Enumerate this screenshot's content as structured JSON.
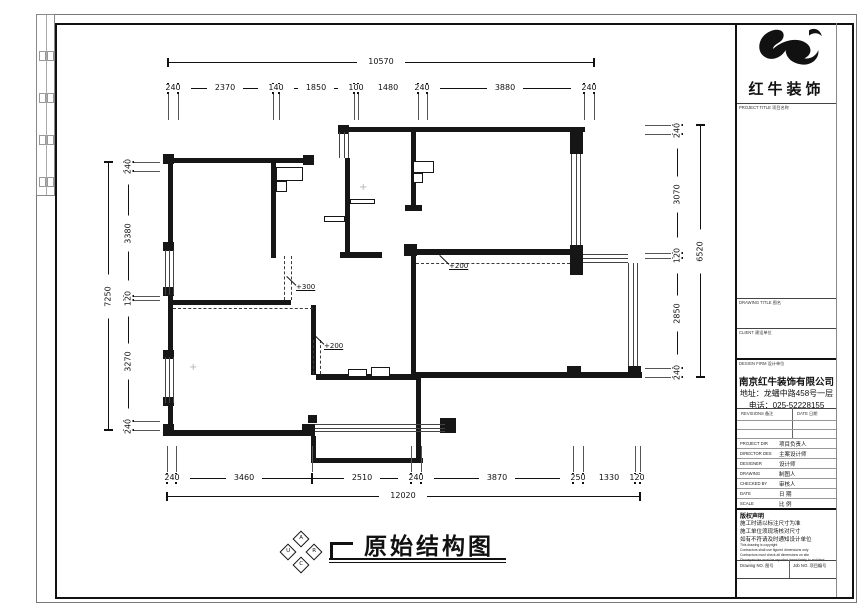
{
  "title_block": {
    "brand": {
      "name": "红牛装饰"
    },
    "labels": {
      "project_title": "PROJECT TITLE 项目名称",
      "drawing_title": "DRAWING TITLE 图名",
      "client": "CLIENT 建设单位",
      "design_firm": "DESIGN FIRM 设计单位"
    },
    "company": {
      "name": "南京红牛装饰有限公司",
      "address": "地址：龙蟠中路458号一层",
      "phone": "电话：025-52228155"
    },
    "revisions_header": {
      "revisions": "REVISIONS 备注",
      "date": "DATE 日期"
    },
    "staff_rows": [
      {
        "en": "PROJECT DIR",
        "zh": "项目负责人"
      },
      {
        "en": "DIRECTOR DES",
        "zh": "主案设计师"
      },
      {
        "en": "DESIGNER",
        "zh": "设计师"
      },
      {
        "en": "DRAWING",
        "zh": "制图人"
      },
      {
        "en": "CHECKED BY",
        "zh": "审核人"
      },
      {
        "en": "DATE",
        "zh": "日  期"
      },
      {
        "en": "SCALE",
        "zh": "比  例"
      }
    ],
    "notes": {
      "title": "版权声明",
      "lines_zh": [
        "施工时请以标注尺寸为准",
        "施工单位须现场核对尺寸",
        "如有不符请及时通知设计单位"
      ],
      "lines_en": [
        "This drawing is copyright",
        "Contractors shall use figured dimensions only",
        "Contractors must check all dimensions on site",
        "Discrepancies must be reported immediately to architect"
      ]
    },
    "footer": {
      "drawing_no": "Drawing NO. 图号",
      "job_no": "Job NO. 项目编号"
    }
  },
  "drawing": {
    "title": "原始结构图",
    "logo_letters": [
      "A",
      "U",
      "R",
      "C"
    ],
    "dimensions": {
      "top": {
        "overall": "10570",
        "segments": [
          "240",
          "2370",
          "140",
          "1850",
          "100",
          "1480",
          "240",
          "3880",
          "240"
        ]
      },
      "bottom": {
        "overall": "12020",
        "segments": [
          "240",
          "3460",
          "2510",
          "240",
          "3870",
          "250",
          "1330",
          "120"
        ]
      },
      "left": {
        "overall": "7250",
        "segments": [
          "240",
          "3380",
          "120",
          "3270",
          "240"
        ]
      },
      "right": {
        "overall": "6520",
        "segments": [
          "240",
          "3070",
          "120",
          "2850",
          "240"
        ]
      }
    },
    "dims_px": {
      "top": {
        "y": 88,
        "oy": 62,
        "ox": 381,
        "overall": "10570",
        "side": "down",
        "ticks": [
          168,
          178,
          273,
          279,
          354,
          358,
          418,
          427,
          584,
          594
        ],
        "labels": [
          [
            "240",
            173
          ],
          [
            "2370",
            225
          ],
          [
            "140",
            276
          ],
          [
            "1850",
            316
          ],
          [
            "100",
            356
          ],
          [
            "1480",
            388
          ],
          [
            "240",
            422
          ],
          [
            "3880",
            505
          ],
          [
            "240",
            589
          ]
        ]
      },
      "bottom": {
        "y": 478,
        "oy": 496,
        "ox": 403,
        "overall": "12020",
        "side": "up",
        "ticks": [
          167,
          176,
          312,
          411,
          421,
          573,
          583,
          635,
          640
        ],
        "labels": [
          [
            "240",
            172
          ],
          [
            "3460",
            244
          ],
          [
            "2510",
            362
          ],
          [
            "240",
            416
          ],
          [
            "3870",
            497
          ],
          [
            "250",
            578
          ],
          [
            "1330",
            609
          ],
          [
            "120",
            637
          ]
        ]
      },
      "left": {
        "x": 128,
        "ox": 108,
        "oyc": 296,
        "overall": "7250",
        "side": "right",
        "ticks": [
          162,
          171,
          296,
          300,
          421,
          430
        ],
        "labels": [
          [
            "240",
            166
          ],
          [
            "3380",
            233
          ],
          [
            "120",
            298
          ],
          [
            "3270",
            361
          ],
          [
            "240",
            426
          ]
        ]
      },
      "right": {
        "x": 677,
        "ox": 700,
        "oyc": 251,
        "overall": "6520",
        "side": "left",
        "ticks": [
          125,
          134,
          253,
          258,
          368,
          377
        ],
        "labels": [
          [
            "240",
            130
          ],
          [
            "3070",
            194
          ],
          [
            "120",
            255
          ],
          [
            "2850",
            313
          ],
          [
            "240",
            372
          ]
        ]
      }
    },
    "geometry": {
      "walls": [
        [
          168,
          158,
          145,
          5
        ],
        [
          342,
          127,
          243,
          5
        ],
        [
          168,
          163,
          5,
          85
        ],
        [
          168,
          295,
          5,
          62
        ],
        [
          168,
          405,
          5,
          31
        ],
        [
          168,
          430,
          147,
          6
        ],
        [
          271,
          163,
          5,
          95
        ],
        [
          345,
          158,
          5,
          100
        ],
        [
          340,
          252,
          42,
          6
        ],
        [
          411,
          132,
          5,
          78
        ],
        [
          405,
          205,
          17,
          6
        ],
        [
          411,
          249,
          161,
          6
        ],
        [
          411,
          255,
          5,
          120
        ],
        [
          171,
          300,
          120,
          5
        ],
        [
          311,
          305,
          5,
          70
        ],
        [
          311,
          436,
          5,
          27
        ],
        [
          311,
          458,
          112,
          5
        ],
        [
          416,
          378,
          5,
          83
        ],
        [
          316,
          374,
          102,
          6
        ],
        [
          416,
          372,
          226,
          6
        ],
        [
          570,
          127,
          13,
          27
        ],
        [
          570,
          245,
          13,
          30
        ],
        [
          567,
          366,
          14,
          12
        ],
        [
          628,
          366,
          13,
          12
        ],
        [
          303,
          155,
          11,
          10
        ],
        [
          338,
          125,
          11,
          9
        ],
        [
          163,
          154,
          11,
          10
        ],
        [
          163,
          242,
          11,
          9
        ],
        [
          163,
          287,
          11,
          9
        ],
        [
          163,
          350,
          11,
          9
        ],
        [
          163,
          397,
          11,
          9
        ],
        [
          163,
          424,
          11,
          12
        ],
        [
          302,
          424,
          13,
          12
        ],
        [
          440,
          418,
          16,
          15
        ],
        [
          404,
          244,
          13,
          12
        ],
        [
          308,
          415,
          9,
          8
        ]
      ],
      "outlines": [
        [
          276,
          167,
          27,
          14
        ],
        [
          276,
          181,
          11,
          11
        ],
        [
          413,
          161,
          21,
          12
        ],
        [
          413,
          173,
          10,
          10
        ],
        [
          324,
          216,
          21,
          6
        ],
        [
          350,
          199,
          25,
          5
        ],
        [
          348,
          369,
          19,
          8
        ],
        [
          371,
          367,
          19,
          10
        ]
      ],
      "windows": [
        [
          165,
          250,
          9,
          45,
          "v"
        ],
        [
          165,
          357,
          9,
          46,
          "v"
        ],
        [
          339,
          132,
          10,
          26,
          "v"
        ],
        [
          571,
          154,
          10,
          91,
          "v"
        ],
        [
          628,
          263,
          10,
          103,
          "v"
        ],
        [
          583,
          254,
          45,
          9,
          "h"
        ],
        [
          315,
          424,
          130,
          8,
          "h"
        ]
      ],
      "dashed": [
        [
          284,
          256,
          44,
          "v"
        ],
        [
          291,
          256,
          44,
          "v"
        ],
        [
          313,
          340,
          34,
          "v"
        ],
        [
          320,
          340,
          34,
          "v"
        ],
        [
          416,
          263,
          154,
          "h"
        ],
        [
          173,
          308,
          140,
          "h"
        ]
      ],
      "levels": [
        {
          "t": "+300",
          "tx": 296,
          "ty": 284,
          "lx": 287,
          "ly": 276
        },
        {
          "t": "+200",
          "tx": 324,
          "ty": 343,
          "lx": 315,
          "ly": 335
        },
        {
          "t": "+200",
          "tx": 449,
          "ty": 263,
          "lx": 440,
          "ly": 255
        }
      ],
      "markers": [
        [
          363,
          188
        ],
        [
          193,
          368
        ]
      ]
    }
  }
}
